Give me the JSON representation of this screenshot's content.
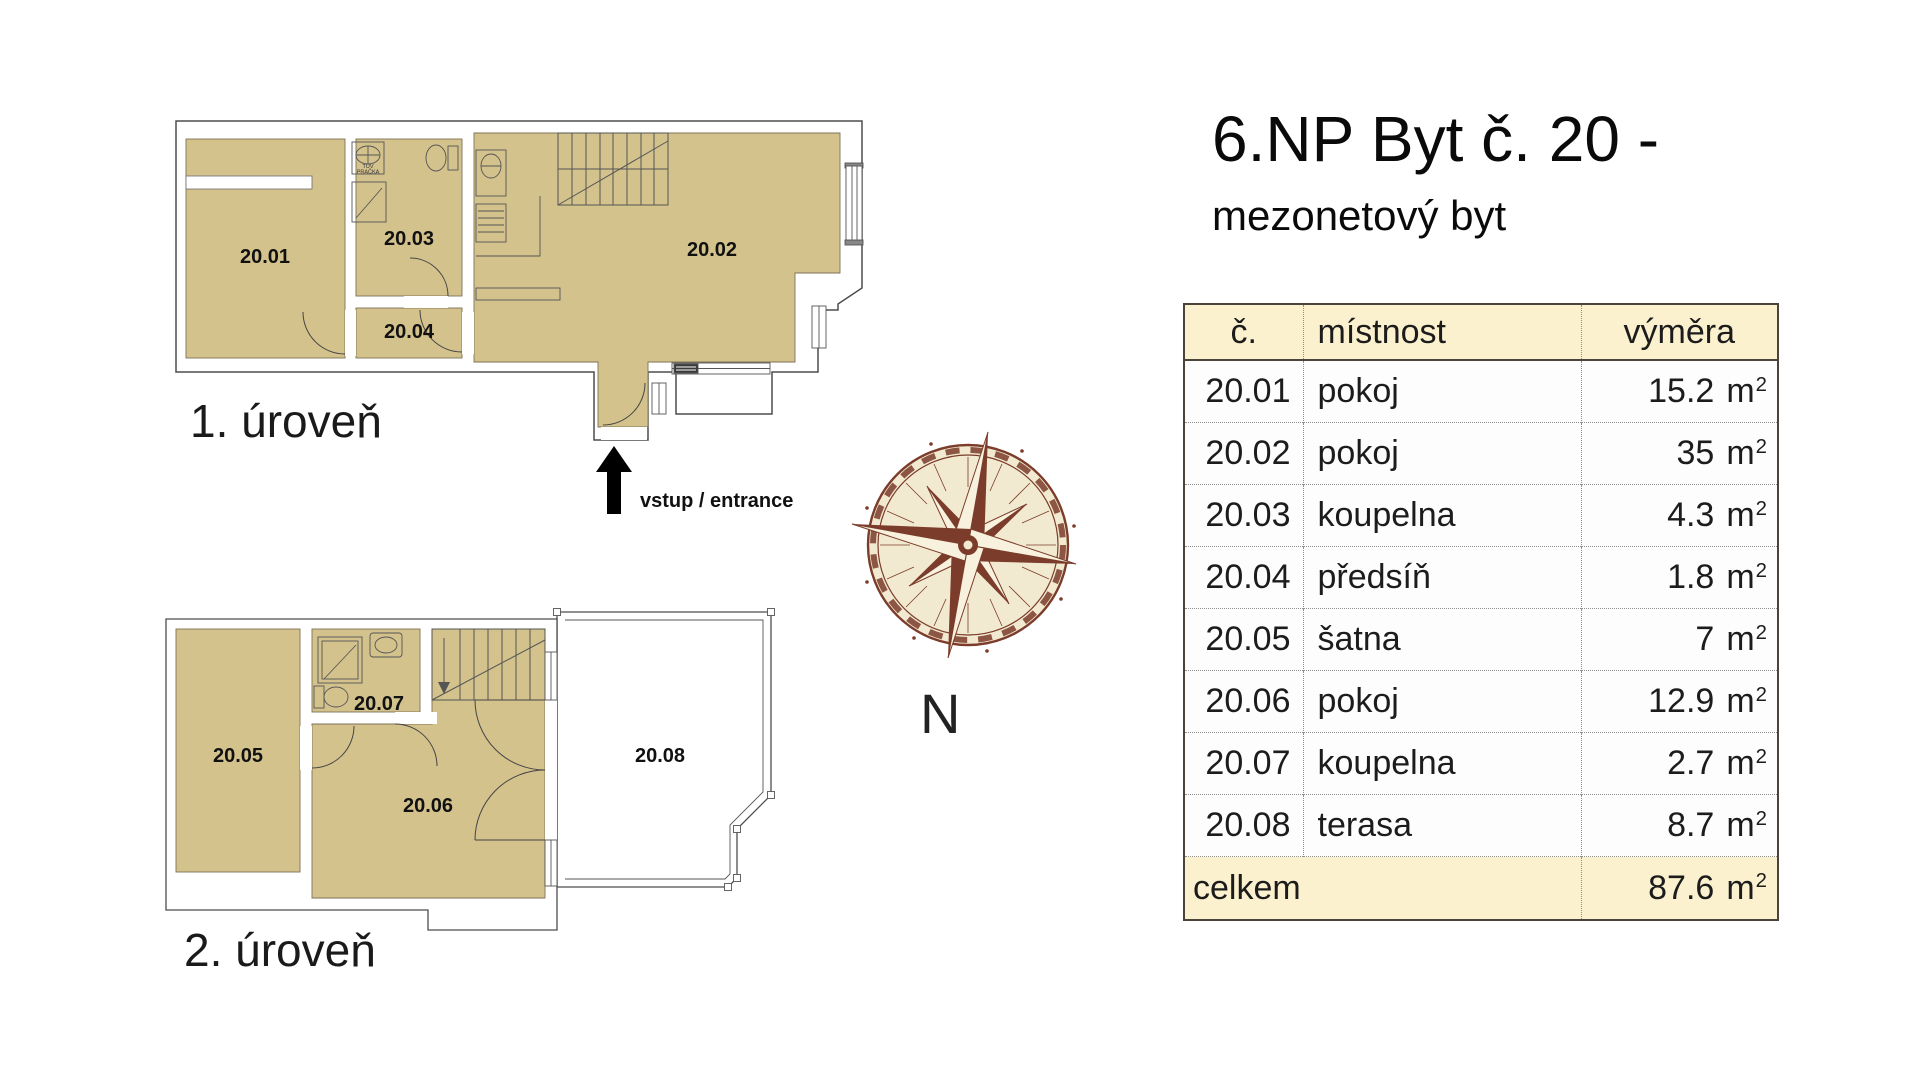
{
  "title": {
    "line1": "6.NP Byt č. 20 -",
    "line2": "mezonetový byt"
  },
  "plans": {
    "level1": {
      "label": "1. úroveň",
      "entrance": "vstup / entrance",
      "room_ids": {
        "r2001": "20.01",
        "r2002": "20.02",
        "r2003": "20.03",
        "r2004": "20.04"
      },
      "fixtures": {
        "line1": "TUV",
        "line2": "PRAČKA"
      }
    },
    "level2": {
      "label": "2. úroveň",
      "room_ids": {
        "r2005": "20.05",
        "r2006": "20.06",
        "r2007": "20.07",
        "r2008": "20.08"
      }
    }
  },
  "compass": {
    "north": "N"
  },
  "table": {
    "headers": {
      "no": "č.",
      "room": "místnost",
      "area": "výměra"
    },
    "unit": "m",
    "unit_sup": "2",
    "rows": [
      {
        "no": "20.01",
        "room": "pokoj",
        "area": "15.2"
      },
      {
        "no": "20.02",
        "room": "pokoj",
        "area": "35"
      },
      {
        "no": "20.03",
        "room": "koupelna",
        "area": "4.3"
      },
      {
        "no": "20.04",
        "room": "předsíň",
        "area": "1.8"
      },
      {
        "no": "20.05",
        "room": "šatna",
        "area": "7"
      },
      {
        "no": "20.06",
        "room": "pokoj",
        "area": "12.9"
      },
      {
        "no": "20.07",
        "room": "koupelna",
        "area": "2.7"
      },
      {
        "no": "20.08",
        "room": "terasa",
        "area": "8.7"
      }
    ],
    "total": {
      "label": "celkem",
      "area": "87.6"
    }
  },
  "colors": {
    "room_fill": "#d4c28d",
    "wall_line": "#4d4d4d",
    "compass_brown": "#7b3c2b",
    "compass_cream": "#f2ead0",
    "table_header_bg": "#fbf1ce"
  }
}
